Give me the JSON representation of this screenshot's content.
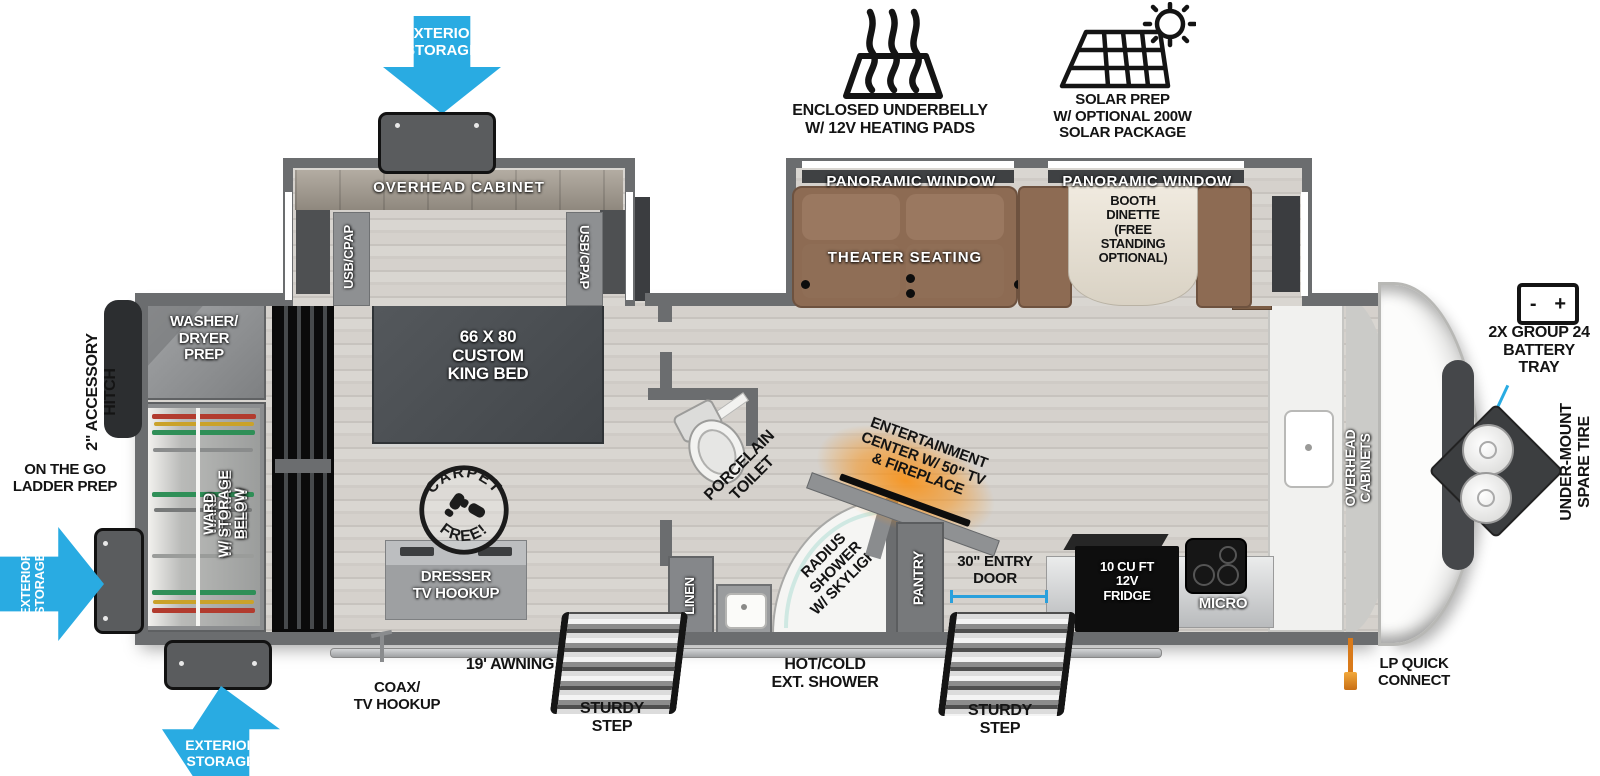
{
  "colors": {
    "accent_blue": "#29abe2",
    "fireplace_glow": "#f7941e",
    "sofa_brown": "#8d6b53",
    "wall_gray": "#6b6d6f"
  },
  "exterior": {
    "top_storage_arrow": "EXTERIOR\nSTORAGE",
    "underbelly_label": "ENCLOSED UNDERBELLY\nW/ 12V HEATING PADS",
    "solar_label": "SOLAR PREP\nW/ OPTIONAL 200W\nSOLAR PACKAGE",
    "battery_label": "2X GROUP 24\nBATTERY\nTRAY",
    "battery_minus": "-",
    "battery_plus": "+",
    "spare_tire_label": "UNDER-MOUNT\nSPARE TIRE",
    "lp_label": "LP QUICK\nCONNECT",
    "hitch_label": "2\" ACCESSORY\nHITCH",
    "ladder_label": "ON THE GO\nLADDER PREP",
    "left_storage_arrow": "EXTERIOR\nSTORAGE",
    "bottom_storage_arrow": "EXTERIOR\nSTORAGE",
    "coax_label": "COAX/\nTV HOOKUP",
    "awning_label": "19' AWNING",
    "mid_step_label": "STURDY\nSTEP",
    "ext_shower_label": "HOT/COLD\nEXT. SHOWER",
    "entry_step_label": "STURDY\nSTEP",
    "entry_door_label": "30\" ENTRY\nDOOR"
  },
  "interior": {
    "overhead_cabinet": "OVERHEAD CABINET",
    "usb_cpap_left": "USB/CPAP",
    "usb_cpap_right": "USB/CPAP",
    "king_bed": "66 X  80\nCUSTOM\nKING BED",
    "washer_dryer": "WASHER/\nDRYER\nPREP",
    "ward": "WARD\nW/ STORAGE\nBELOW",
    "dresser": "DRESSER\nTV HOOKUP",
    "carpet_top": "CARPET",
    "carpet_bottom": "FREE!",
    "toilet_label": "PORCELAIN\nTOILET",
    "linen": "LINEN",
    "shower_label": "RADIUS\nSHOWER\nW/ SKYLIGHT",
    "pantry": "PANTRY",
    "entertainment": "ENTERTAINMENT\nCENTER W/ 50\" TV\n& FIREPLACE",
    "panoramic_window_left": "PANORAMIC WINDOW",
    "panoramic_window_right": "PANORAMIC WINDOW",
    "theater_seating": "THEATER SEATING",
    "booth_dinette": "BOOTH\nDINETTE\n(FREE\nSTANDING\nOPTIONAL)",
    "fridge": "10 CU FT\n12V\nFRIDGE",
    "micro": "MICRO",
    "overhead_cabinets": "OVERHEAD\nCABINETS"
  }
}
